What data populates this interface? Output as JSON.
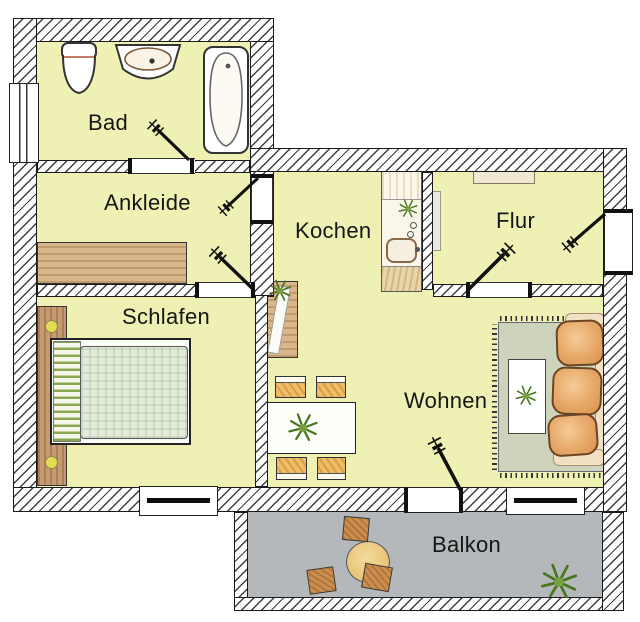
{
  "rooms": [
    {
      "id": "bad",
      "label": "Bad"
    },
    {
      "id": "ankleide",
      "label": "Ankleide"
    },
    {
      "id": "kochen",
      "label": "Kochen"
    },
    {
      "id": "flur",
      "label": "Flur"
    },
    {
      "id": "schlafen",
      "label": "Schlafen"
    },
    {
      "id": "wohnen",
      "label": "Wohnen"
    },
    {
      "id": "balkon",
      "label": "Balkon"
    }
  ],
  "colors": {
    "room_fill": "#eff1b4",
    "balcony_floor": "#b4b8bb",
    "wall_outline": "#1a1a1a",
    "hatch_line": "#3f3f3f",
    "label_text": "#161616",
    "wood": "#d9b68c",
    "sofa": "#e7a868",
    "rug": "#ced3bc"
  },
  "furniture_icons": {
    "bad": [
      "toilet-icon",
      "washbasin-icon",
      "bathtub-icon",
      "window"
    ],
    "ankleide": [
      "wardrobe"
    ],
    "schlafen": [
      "headboard",
      "double-bed",
      "bedside-lamps",
      "window"
    ],
    "kochen": [
      "kitchen-counter",
      "kitchen-sink",
      "plant-icon",
      "sideboard"
    ],
    "flur": [
      "wall-shelf",
      "entrance-door",
      "coat-panel"
    ],
    "wohnen": [
      "dining-table",
      "chairs",
      "rug",
      "sofa",
      "coffee-table",
      "plant-icon",
      "window",
      "balcony-door"
    ],
    "balkon": [
      "round-table",
      "stools",
      "plant-icon"
    ]
  }
}
